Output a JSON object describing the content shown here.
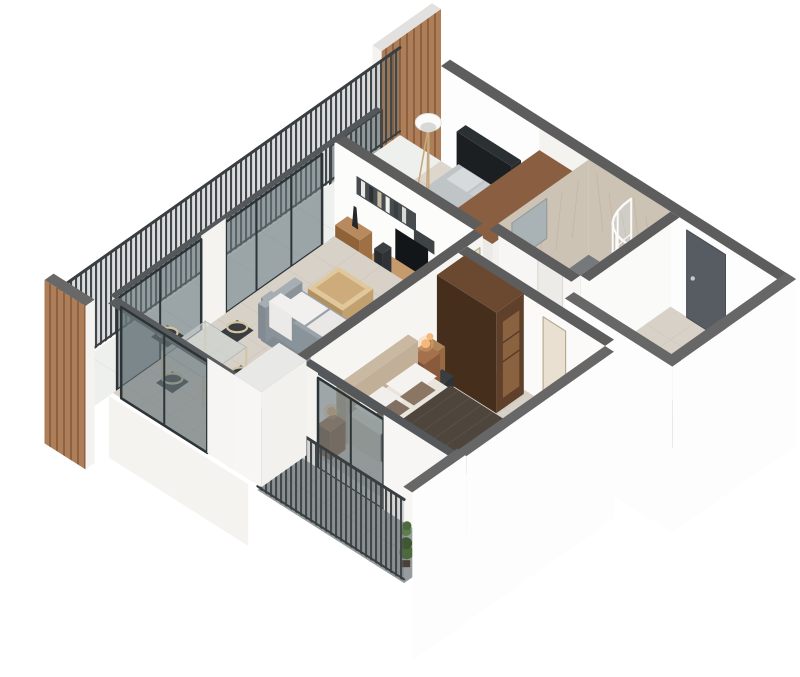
{
  "scene": {
    "label": "3D isometric render of a one-bedroom-plus apartment floor plan, viewed from above the south corner",
    "type": "isometric-floor-plan-render",
    "background": "#ffffff"
  },
  "palette": {
    "background": "#ffffff",
    "wall_top": "#5d5d5d",
    "wall_top_light": "#676767",
    "wall_white": "#fdfdfd",
    "wall_white_dim": "#f4f3f0",
    "wall_shadow": "#ebeae7",
    "floor_beige": "#d7d1c7",
    "floor_beige_line": "#c7c0b5",
    "floor_beige_light": "#dcd6cd",
    "balcony_gray": "#979d9e",
    "balcony_gray_line": "#858c8d",
    "balcony_white": "#eef0ee",
    "balcony_white_line": "#e0e2de",
    "bath_floor": "#75797b",
    "bath_floor_line": "#636869",
    "marble": "#cdc3b5",
    "marble_streak": "#b9ad9d",
    "wood_slat": "#ad7e57",
    "wood_slat_dark": "#8d6243",
    "wood_warm": "#b98a5e",
    "wood_warm_top": "#c59a6c",
    "wood_warm_dark": "#9c7349",
    "wood_cap": "#8a5f41",
    "wardrobe": "#5f402a",
    "wardrobe_dark": "#462e1d",
    "wardrobe_top": "#6b4930",
    "wardrobe_open": "#8a6240",
    "bench_wood": "#8a5c3c",
    "bench_wood_dark": "#6f4930",
    "door_dark": "#565c61",
    "door_light": "#e6dcc9",
    "door_frame": "#b9ab90",
    "glass": "rgba(104,118,122,0.62)",
    "glass_frame": "#2d3437",
    "railing_bar": "#42484a",
    "railing_bg": "rgba(90,97,99,0.22)",
    "rail_top": "#393e40",
    "sofa": "#9aa3a9",
    "sofa_dark": "#8a939a",
    "sofa_light": "#a7aeb3",
    "cushion_white": "#f1f0ee",
    "table_wood": "#e0c79c",
    "table_wood_dark": "#c2a170",
    "table_wood_inner": "#cdab7a",
    "tv_black": "#131619",
    "shelf_dark": "#474d4f",
    "bed2_head": "#23272a",
    "bed2_sheet": "#bfc4c6",
    "bed2_side": "#a7acaf",
    "bed2_blanket": "#8e959a",
    "pillow_gray": "#d6dadc",
    "bed_head": "#c9b8a2",
    "bed_sheet": "#eae5dc",
    "bed_sheet_side": "#d4cdc0",
    "bed_blanket": "#4e453c",
    "bed_blanket_dark": "#433b33",
    "pillow_white": "#f5f3ef",
    "pillow_brown": "#8a7663",
    "rug_blue": "#b6cfdd",
    "rug_blue_line": "#a4c1d2",
    "nightstand": "#a5714d",
    "nightstand_dark": "#8a5a3c",
    "lamp_glow": "#f4b87a",
    "chair_seat": "#393d3f",
    "chair_frame": "#d5c4a1",
    "plant_green": "#4e6a3d",
    "plant_green_dark": "#3f5732",
    "plant_green_light": "#5f7f4a",
    "shower_white": "#fafaf9",
    "shower_glass": "rgba(210,220,223,0.38)",
    "mirror": "#a9b2b4",
    "sink_white": "#f6f6f4"
  },
  "inventory": {
    "rooms": [
      {
        "name": "living-room",
        "floor": "beige tile",
        "items": [
          "gray-sofa",
          "white-cushions",
          "light-wood-coffee-table",
          "tv-console",
          "wall-mounted-tv",
          "dark-wall-shelves-with-books",
          "glass-dining-table",
          "four-chairs",
          "glass-sliding-doors"
        ]
      },
      {
        "name": "bedroom-north",
        "floor": "beige tile",
        "items": [
          "double-bed-dark-headboard",
          "gray-bedding",
          "tripod-floor-lamp",
          "built-in-closet-wood-top",
          "balcony-glass-door"
        ]
      },
      {
        "name": "bathroom",
        "floor": "dark gray tile",
        "items": [
          "curved-corner-shower",
          "washbasin",
          "mirror",
          "marble-walls"
        ]
      },
      {
        "name": "entry-hall",
        "floor": "beige tile",
        "items": [
          "dark-entry-door",
          "wooden-bench"
        ]
      },
      {
        "name": "master-bedroom",
        "floor": "beige tile",
        "items": [
          "double-bed-brown-blanket",
          "beige-headboard",
          "nightstands-with-lit-lamps",
          "dark-brown-wardrobe",
          "desk-with-lamp",
          "chair",
          "light-blue-rug",
          "wood-door",
          "glass-wall-to-balcony"
        ]
      },
      {
        "name": "balcony-northwest",
        "floor": "white",
        "items": [
          "slatted-railing",
          "wood-slat-tower-wall",
          "wood-slat-end-panel"
        ]
      },
      {
        "name": "balcony-south",
        "floor": "gray tile",
        "items": [
          "slatted-railing",
          "climbing-plant"
        ]
      }
    ]
  }
}
